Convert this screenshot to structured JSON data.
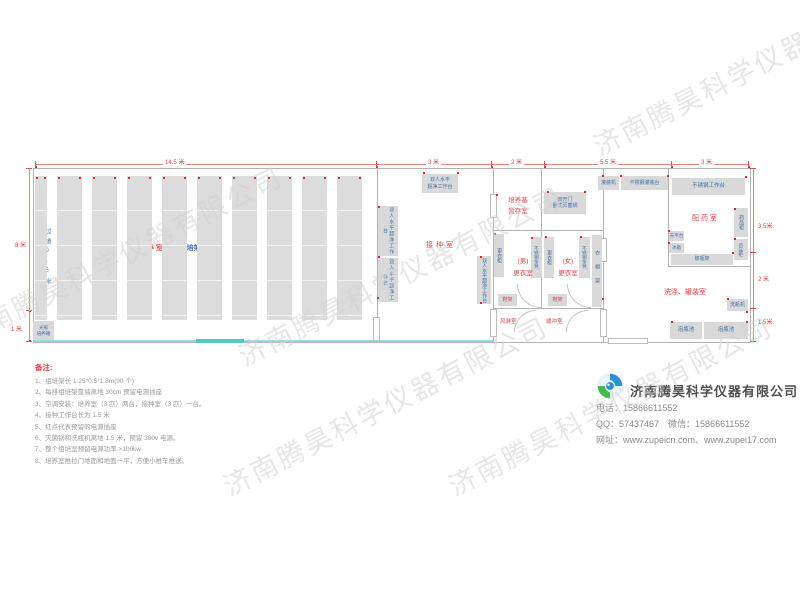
{
  "watermark": {
    "text": "济南腾昊科学仪器有限公司"
  },
  "dims": {
    "top": [
      "14.5 米",
      "3 米",
      "2 米",
      "5.5 米",
      "3 米"
    ],
    "left": [
      "8 米",
      "1 米"
    ],
    "right": [
      "3.5米",
      "2 米",
      "1.5米"
    ]
  },
  "rooms": {
    "culture_red": "培 养 室",
    "culture_blue": "90个组培架",
    "aisle": "过道0.6米",
    "inoculation": "接种室",
    "medium_l1": "培养基",
    "medium_l2": "暂存室",
    "male_tag": "(男)",
    "male_name": "更衣室",
    "female_tag": "(女)",
    "female_name": "更衣室",
    "air_shower": "风淋室",
    "buffer": "缓冲室",
    "dispensing": "配 药 室",
    "washing": "洗涤、罐装室"
  },
  "equipment": {
    "workbench_top_l1": "双人水平",
    "workbench_top_l2": "超净工作台",
    "workbench_side": "双人水平超净工作台",
    "sterilizer_l1": "双开门",
    "sterilizer_l2": "卧式灭菌锅",
    "locker": "更衣柜",
    "bench": "不锈钢条凳",
    "coatrack": "衣帽架",
    "shoerack": "鞋架",
    "filling_machine": "灌装机",
    "filling_table": "不锈钢灌装台",
    "worktable": "不锈钢工作台",
    "med_cabinet": "药品柜",
    "balance": "天平台",
    "fridge": "冰箱",
    "bottle_rack": "玻瓶架",
    "bottle_washer": "洗瓶机",
    "soak_pool": "泡瓶池",
    "incubator_l1": "光照",
    "incubator_l2": "培养箱"
  },
  "notes": {
    "title": "备注:",
    "items": [
      "1、组培架长 1.25*0.5*1.8m(90 个)",
      "2、每排组培架靠墙离地 30cm 预留电源插座",
      "3、空调安装：培养室（3 匹）两台，接种室（3 匹）一台。",
      "4、接种工作台长为 1.5 米",
      "5、红点代表预留的电源插座",
      "6、灭菌锅和洗瓶机离地 1.5 米，预留 380v 电源。",
      "7、整个组培室预留电源功率 >100kw",
      "8、培养室推拉门地面和地面一平，方便小推车推送。"
    ]
  },
  "company": {
    "name": "济南腾昊科学仪器有限公司",
    "line1": "电话：15866611552",
    "line2": "QQ：57437467　微信：15866611552",
    "line3": "网址：www.zupeicn.com、www.zupei17.com"
  },
  "generated": {
    "racks": {
      "y": 176,
      "h": 144,
      "items": [
        [
          35,
          12
        ],
        [
          57,
          25
        ],
        [
          92,
          25
        ],
        [
          127,
          25
        ],
        [
          162,
          25
        ],
        [
          197,
          25
        ],
        [
          232,
          25
        ],
        [
          267,
          25
        ],
        [
          302,
          25
        ],
        [
          337,
          25
        ]
      ]
    },
    "dots": [
      [
        423,
        172
      ],
      [
        457,
        172
      ],
      [
        378,
        206
      ],
      [
        378,
        256
      ],
      [
        377,
        297
      ],
      [
        480,
        256
      ],
      [
        480,
        302
      ],
      [
        494,
        233
      ],
      [
        531,
        237
      ],
      [
        545,
        236
      ],
      [
        580,
        236
      ],
      [
        547,
        191
      ],
      [
        584,
        191
      ],
      [
        496,
        194
      ],
      [
        602,
        175
      ],
      [
        620,
        175
      ],
      [
        667,
        175
      ],
      [
        745,
        176
      ],
      [
        734,
        208
      ],
      [
        734,
        238
      ],
      [
        668,
        230
      ],
      [
        668,
        242
      ],
      [
        732,
        252
      ],
      [
        727,
        298
      ],
      [
        746,
        311
      ],
      [
        671,
        321
      ],
      [
        746,
        321
      ],
      [
        602,
        298
      ],
      [
        35,
        166
      ],
      [
        376,
        166
      ],
      [
        491,
        166
      ],
      [
        544,
        166
      ],
      [
        671,
        166
      ],
      [
        748,
        166
      ],
      [
        29,
        310
      ],
      [
        29,
        340
      ]
    ],
    "ticks": [
      [
        35,
        161,
        1,
        6
      ],
      [
        376,
        161,
        1,
        6
      ],
      [
        491,
        161,
        1,
        6
      ],
      [
        544,
        161,
        1,
        6
      ],
      [
        671,
        161,
        1,
        6
      ],
      [
        748,
        161,
        1,
        6
      ],
      [
        26,
        168,
        6,
        1
      ],
      [
        26,
        310,
        6,
        1
      ],
      [
        26,
        341,
        6,
        1
      ],
      [
        750,
        168,
        6,
        1
      ],
      [
        750,
        252,
        6,
        1
      ],
      [
        750,
        308,
        6,
        1
      ],
      [
        750,
        341,
        6,
        1
      ]
    ],
    "watermarks": [
      {
        "x": -60,
        "y": 235,
        "r": -27
      },
      {
        "x": 220,
        "y": 255,
        "r": -27
      },
      {
        "x": 205,
        "y": 385,
        "r": -27
      },
      {
        "x": 430,
        "y": 385,
        "r": -27
      },
      {
        "x": 575,
        "y": 45,
        "r": -27
      }
    ]
  }
}
